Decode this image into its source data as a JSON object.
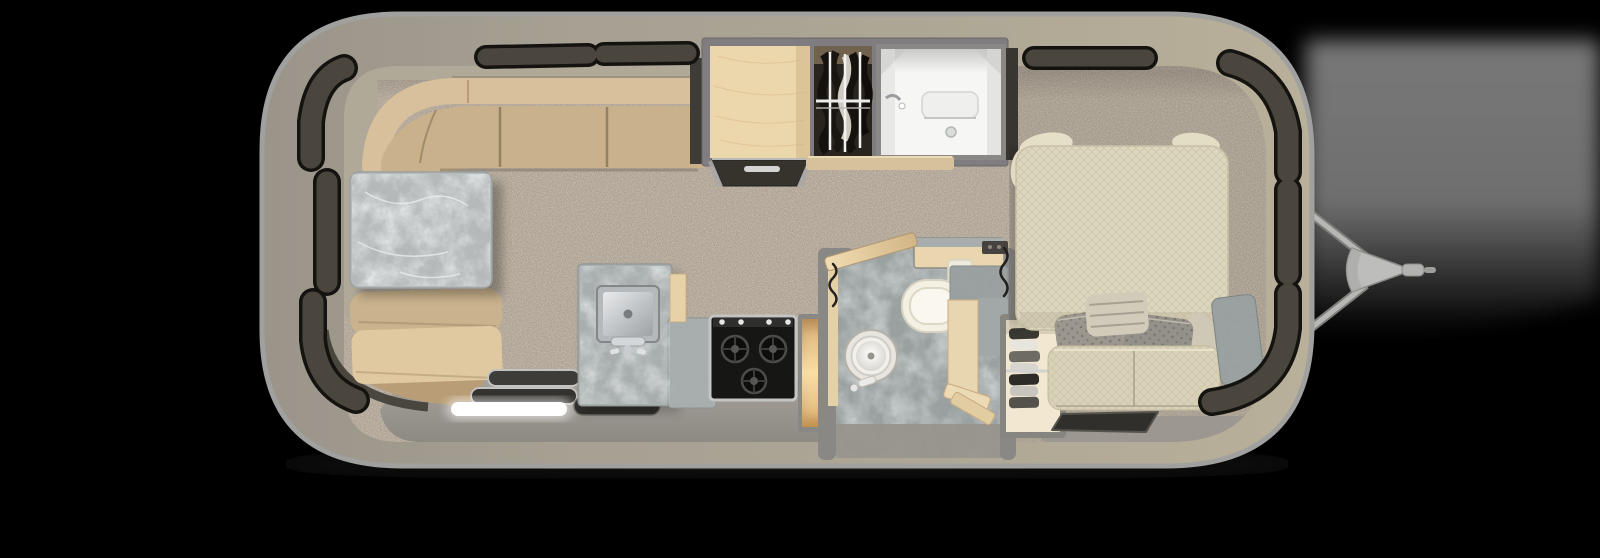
{
  "scene": {
    "type": "travel-trailer-floorplan-top-view",
    "background": "#000000",
    "width": 1600,
    "height": 558
  },
  "palette": {
    "background": "#000000",
    "ground_shadow": "#737373",
    "shell_light": "#b9b09a",
    "shell_dark": "#9a948a",
    "shell_rim": "#a0a09e",
    "window_glass": "#4b463d",
    "window_frame": "#15130f",
    "interior_wall": "#b1a998",
    "carpet": "#ac9f8f",
    "floor_vinyl": "#9c9791",
    "sofa_bolster": "#d7c09b",
    "sofa_cushion": "#c9b18c",
    "sofa_seat": "#e0c9a1",
    "sofa_skirt": "#b89d76",
    "sofa_trim": "#45413a",
    "table_marble": "#b7bbbc",
    "counter_marble": "#a9aeae",
    "bath_marble": "#9aa0a0",
    "wood": "#ecd6ab",
    "wood_trim": "#d6c19a",
    "wood_lit": "#f7dca8",
    "frame_gray": "#8a8884",
    "steel": "#c4c4c2",
    "sink_steel": "#b5b9bb",
    "stove_black": "#161614",
    "appliance_dark": "#36332d",
    "shower_white": "#f6f6f4",
    "closet_dark": "#2a241e",
    "clothes_dark": "#15120e",
    "clothes_light": "#cfcac0",
    "mattress": "#ddd7bf",
    "bench": "#d9d2b8",
    "pillow_cream": "#e6dfc7",
    "pillow_gray": "#9c978e",
    "pillow_gray_2": "#94908a",
    "pillow_throw": "#d2cbba",
    "mat_dark": "#312f2b",
    "mat_edge": "#55524c",
    "led": "#ffffff",
    "toilet": "#f4f0e4",
    "vanity_wood": "#e9d6ae",
    "wardrobe_interior": "#f2e8d2",
    "hitch_metal": "#b7b7b5",
    "hitch_dark": "#7d7d7b"
  },
  "floorplan": {
    "orientation": "hitch-at-right",
    "rear_lounge": {
      "items": [
        "wraparound-sofa",
        "dinette-table",
        "entry-step-led",
        "entry-treads",
        "floor-mats"
      ]
    },
    "galley": {
      "items": [
        "marble-counter",
        "square-sink",
        "faucet",
        "three-burner-range",
        "lit-open-cabinet"
      ]
    },
    "mid_cabinets": {
      "items": [
        "refrigerator-cabinet",
        "hanging-wardrobe",
        "shower-stall"
      ]
    },
    "bathroom": {
      "items": [
        "open-door",
        "toilet",
        "round-vessel-sink",
        "vanity-counter",
        "towel-hook"
      ]
    },
    "front_bedroom": {
      "items": [
        "queen-bed",
        "head-pillows",
        "accent-pillows",
        "throw-pillow",
        "foot-bench",
        "front-wardrobe",
        "floor-mat",
        "corner-marble-shelf"
      ]
    },
    "exterior": {
      "items": [
        "aluminum-shell",
        "panoramic-windows",
        "a-frame-hitch",
        "ground-shadow"
      ]
    }
  }
}
